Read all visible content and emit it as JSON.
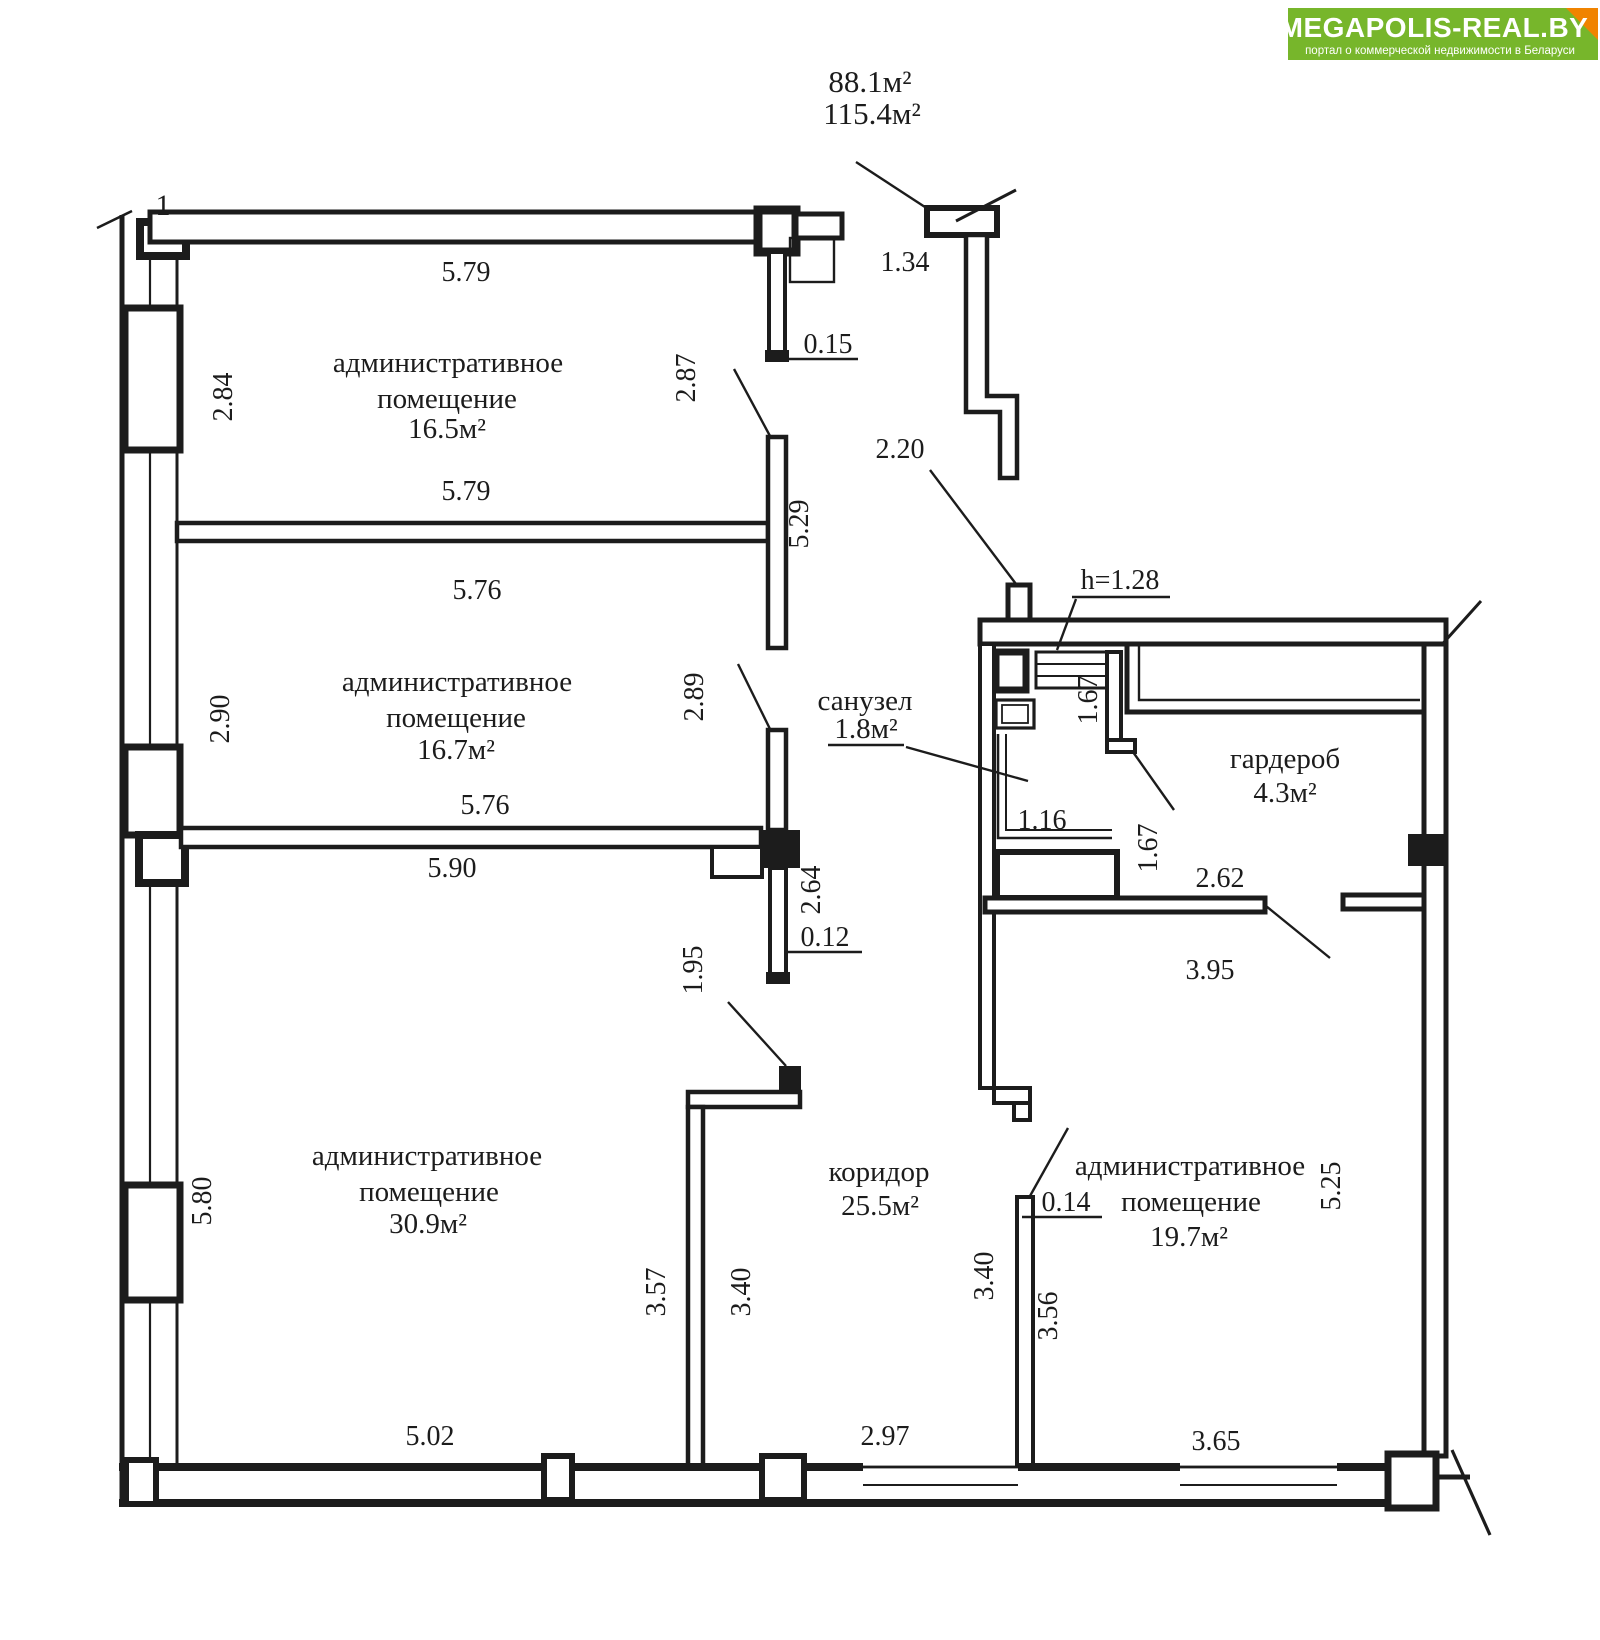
{
  "watermark": {
    "title": "MEGAPOLIS-REAL.BY",
    "subtitle": "портал о коммерческой недвижимости в Беларуси",
    "bg_color": "#77b62b",
    "fold_color": "#f08300"
  },
  "plan": {
    "axis_mark": "1",
    "total_area": {
      "line1": "88.1м²",
      "line2": "115.4м²"
    },
    "rooms": {
      "admin1": {
        "name_line1": "административное",
        "name_line2": "помещение",
        "area": "16.5м²"
      },
      "admin2": {
        "name_line1": "административное",
        "name_line2": "помещение",
        "area": "16.7м²"
      },
      "admin3": {
        "name_line1": "административное",
        "name_line2": "помещение",
        "area": "30.9м²"
      },
      "corridor": {
        "name": "коридор",
        "area": "25.5м²"
      },
      "sanuzel": {
        "name": "санузел",
        "area": "1.8м²"
      },
      "garderob": {
        "name": "гардероб",
        "area": "4.3м²"
      },
      "admin4": {
        "name_line1": "административное",
        "name_line2": "помещение",
        "area": "19.7м²"
      }
    },
    "dims": {
      "d579t": "5.79",
      "d284": "2.84",
      "d579b": "5.79",
      "d576t": "5.76",
      "d290": "2.90",
      "d576b": "5.76",
      "d590": "5.90",
      "d287": "2.87",
      "d529": "5.29",
      "d289": "2.89",
      "d264": "2.64",
      "d012": "0.12",
      "d015": "0.15",
      "d195": "1.95",
      "d134": "1.34",
      "d220": "2.20",
      "h128": "h=1.28",
      "d167a": "1.67",
      "d116": "1.16",
      "d167b": "1.67",
      "d262": "2.62",
      "d395": "3.95",
      "d580": "5.80",
      "d357": "3.57",
      "d340a": "3.40",
      "d340b": "3.40",
      "d356": "3.56",
      "d014": "0.14",
      "d502": "5.02",
      "d297": "2.97",
      "d365": "3.65",
      "d525": "5.25"
    }
  }
}
